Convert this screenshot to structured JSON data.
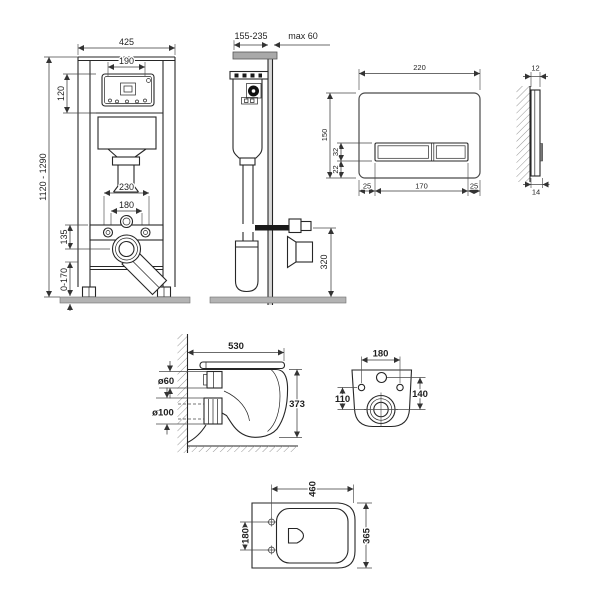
{
  "colors": {
    "line": "#262626",
    "floor_gray": "#b3b3b3",
    "wall_bracket_gray": "#a9a9a9",
    "wall_fill_gray": "#d9d9d9",
    "plate_side_dark": "#666666"
  },
  "drawing": {
    "frame_front": {
      "width": "425",
      "opening_width": "190",
      "window_height": "120",
      "height_range": "1120 - 1290",
      "anchor_span": "230",
      "rod_span": "180",
      "outlet_drop": "135",
      "feet_range": "0-170"
    },
    "frame_side": {
      "depth_range": "155-235",
      "wall_max": "max 60",
      "outlet_height": "320"
    },
    "plate_front": {
      "width": "220",
      "height": "150",
      "button_height": "32",
      "button_offset": "22",
      "margin_left": "25",
      "button_span": "170",
      "margin_right": "25"
    },
    "plate_side": {
      "thickness": "12",
      "total_thickness": "14"
    },
    "bowl_side": {
      "depth": "530",
      "height": "373",
      "inlet_diameter": "ø60",
      "outlet_diameter": "ø100"
    },
    "bowl_rear": {
      "hole_span": "180",
      "hole_height": "110",
      "port_span": "140"
    },
    "bowl_top": {
      "depth": "460",
      "hole_span": "180",
      "width": "365"
    }
  }
}
